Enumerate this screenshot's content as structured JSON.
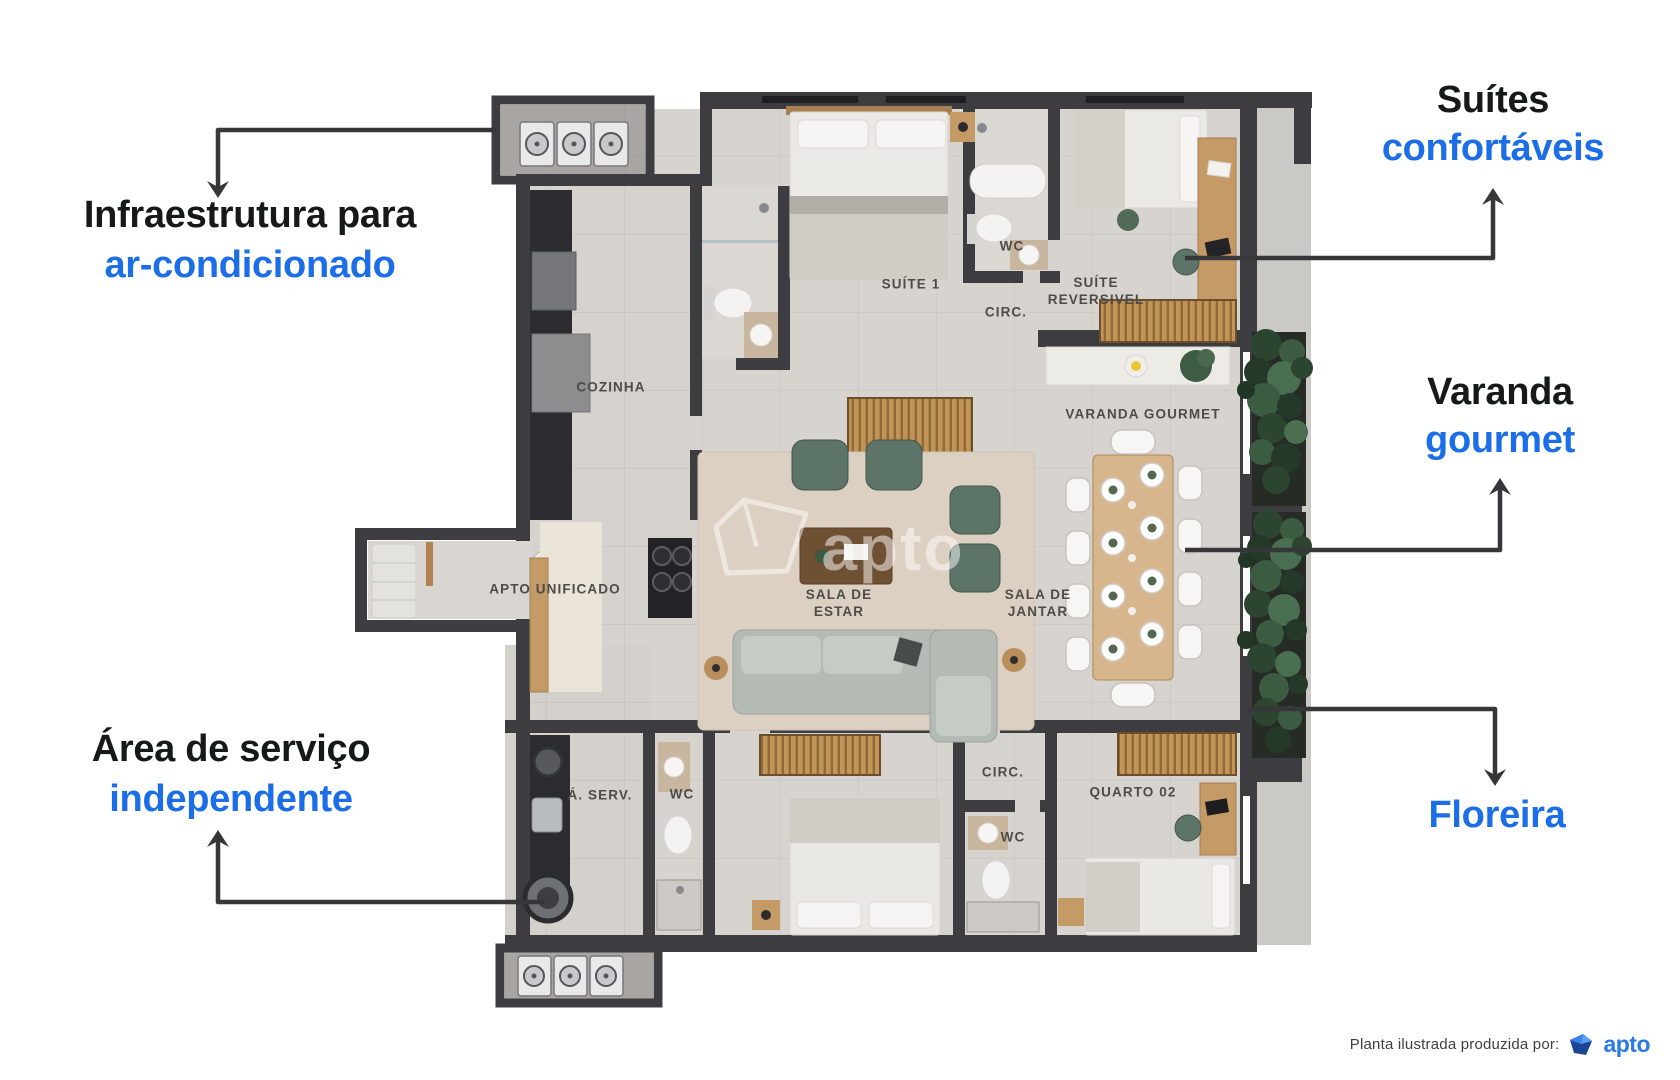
{
  "annotations": {
    "ac_infra": {
      "line1": "Infraestrutura para",
      "line2": "ar-condicionado"
    },
    "suites": {
      "line1": "Suítes",
      "line2": "confortáveis"
    },
    "varanda": {
      "line1": "Varanda",
      "line2": "gourmet"
    },
    "floreira": {
      "line1": "Floreira"
    },
    "servico": {
      "line1": "Área de serviço",
      "line2": "independente"
    }
  },
  "room_labels": {
    "cozinha": "COZINHA",
    "suite1": "SUÍTE 1",
    "wc_suite": "WC",
    "suite_reversivel": "SUÍTE\nREVERSIVEL",
    "circ_top": "CIRC.",
    "varanda_gourmet": "VARANDA GOURMET",
    "apto_unificado": "APTO UNIFICADO",
    "sala_estar": "SALA DE\nESTAR",
    "sala_jantar": "SALA DE\nJANTAR",
    "area_servico": "Á. SERV.",
    "wc_servico": "WC",
    "circ_bottom": "CIRC.",
    "quarto02": "QUARTO 02",
    "wc_bottom": "WC"
  },
  "watermark": {
    "brand": "apto"
  },
  "footer": {
    "credit": "Planta ilustrada produzida por:",
    "brand": "apto"
  },
  "colors": {
    "accent_blue": "#1b6ee8",
    "text_dark": "#17181a",
    "arrow": "#37373a",
    "wall": "#3d3d41"
  }
}
